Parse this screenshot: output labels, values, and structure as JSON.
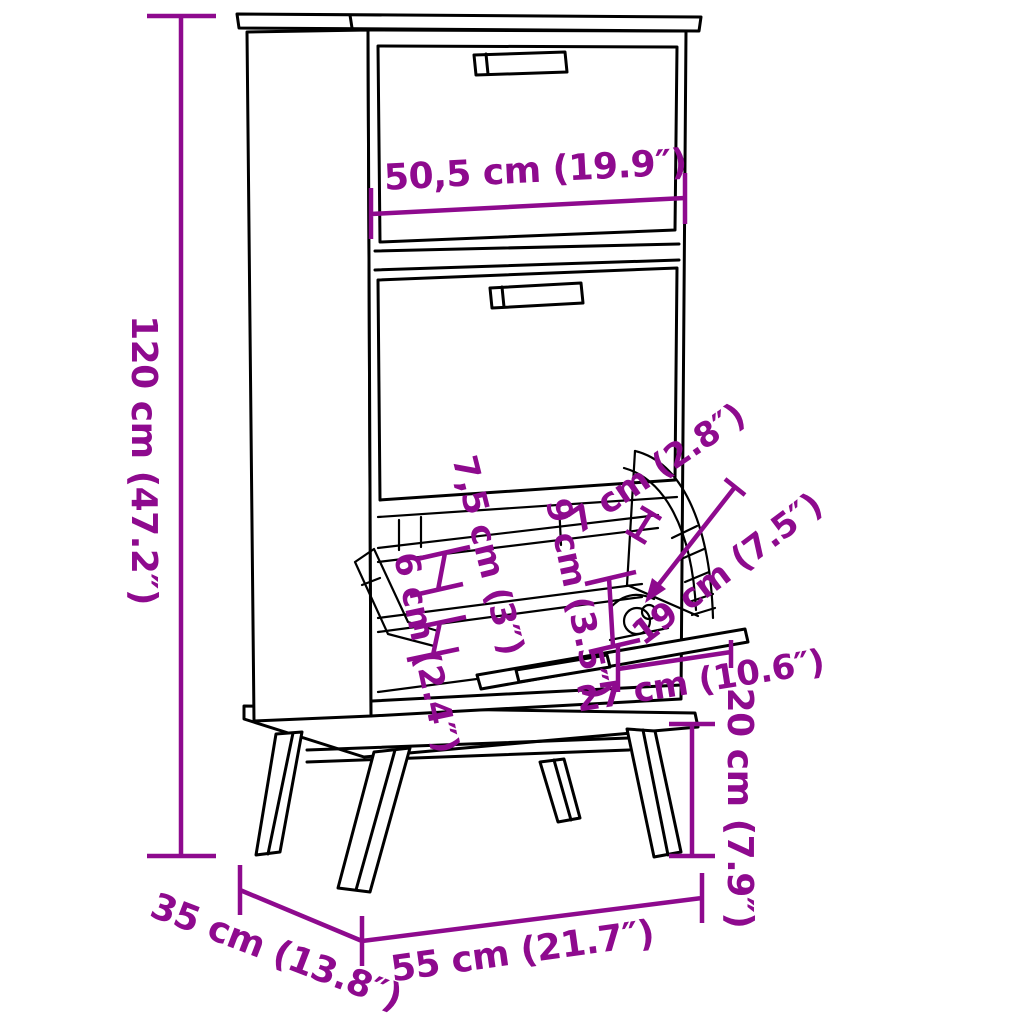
{
  "diagram": {
    "name": "shoe-cabinet-dimension-diagram",
    "subject": "shoe cabinet with two flip-down drawers and angled legs",
    "colors": {
      "background": "#FFFFFF",
      "line_art": "#000000",
      "dimension": "#8E0A8E"
    },
    "labels": {
      "height": "120 cm (47.2″)",
      "top_width": "50,5 cm (19.9″)",
      "slot_front": "7,5 cm (3″)",
      "slot_mid": "9 cm (3.5″)",
      "slot_rear": "6 cm (2.4″)",
      "flap_edge": "7 cm (2.8″)",
      "flap_opening": "19 cm (7.5″)",
      "flap_projection": "27 cm (10.6″)",
      "leg_height": "20 cm (7.9″)",
      "depth": "35 cm (13.8″)",
      "width": "55 cm (21.7″)"
    }
  }
}
